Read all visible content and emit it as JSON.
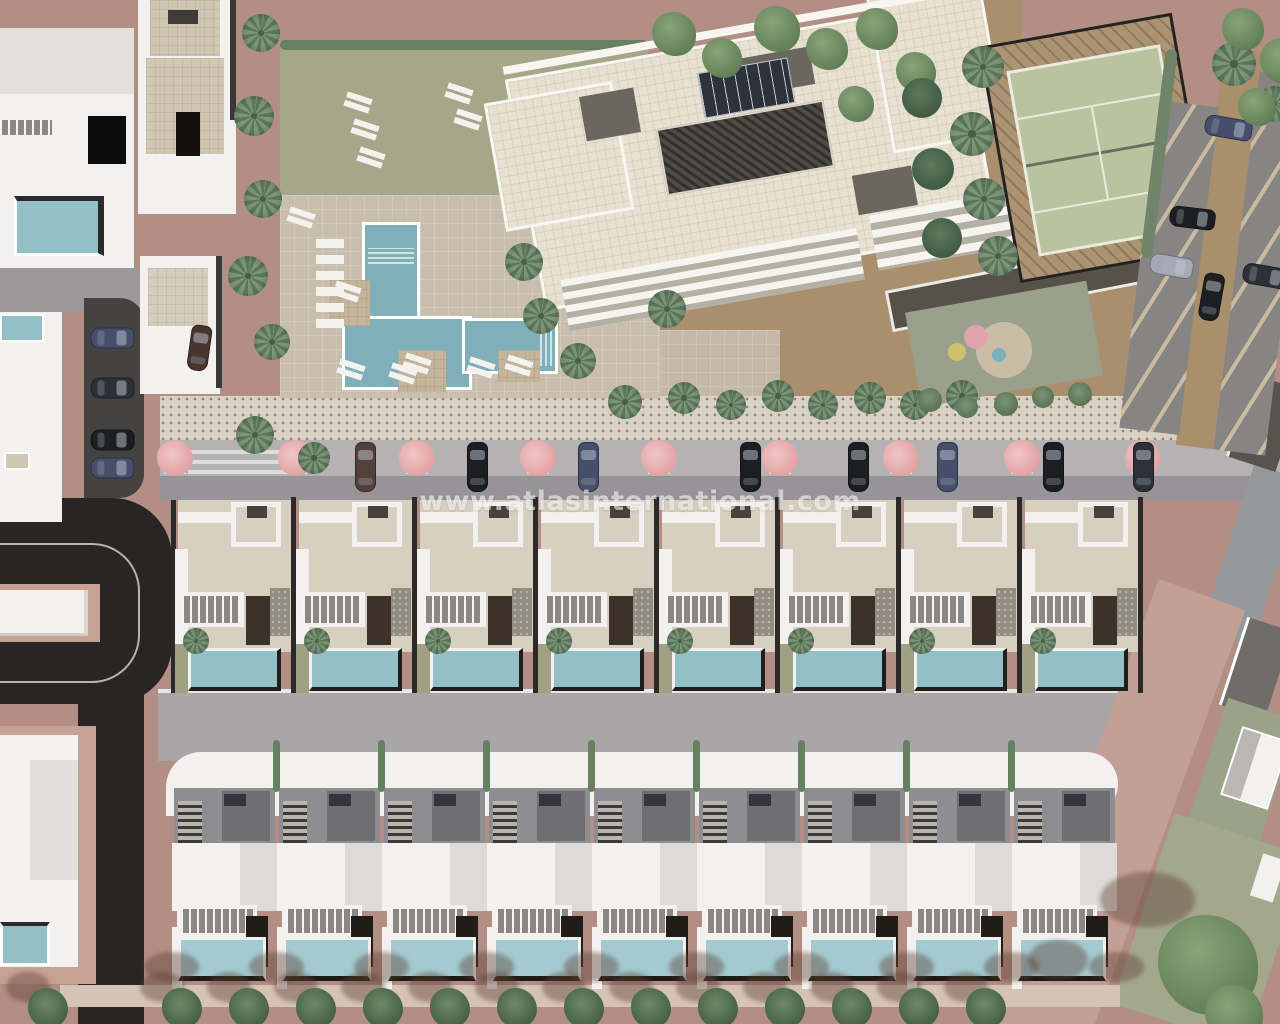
{
  "watermark": {
    "text": "www.atlasinternational.com"
  },
  "palette": {
    "ground": "#b28e85",
    "ground_light": "#c6a294",
    "road_dark": "#282625",
    "road_mid": "#a8a6a7",
    "road_pink": "#c2a095",
    "street_lane": "#969496",
    "street_bays": "#b4b2b3",
    "sidewalk": "#d9d2c4",
    "sidewalk_dot": "#8f8878",
    "lawn": "#a5a789",
    "hedge": "#66815f",
    "deck": "#c8bead",
    "pool": "#7fafb8",
    "villa_pool": "#93bfc6",
    "bottom_pool": "#a3cad0",
    "white": "#f2f1ef",
    "white_shade": "#dcdbd8",
    "beige_roof": "#d7cfbf",
    "beige_wall": "#d0c7b3",
    "stone": "#938c80",
    "olive": "#9fa084",
    "door_brown": "#3d322a",
    "door_dark": "#201c18",
    "roof_gray": "#8e8e92",
    "roof_gray_dark": "#6f6f73",
    "apt_cream": "#e8e1d1",
    "apt_cut": "#6b675f",
    "trellis": "#4e4a44",
    "solar": "#2e333b",
    "tennis_green": "#b9c3a0",
    "tennis_tan": "#ac9372",
    "dirt": "#a98f6e",
    "bay_gray": "#868482",
    "pink_tree": "#e2a2a4",
    "palm": "#7d9478",
    "palm_dark": "#5a775c",
    "watermark": "rgba(255,255,255,0.6)",
    "car_navy": "#454e6b",
    "car_black": "#1d1e21",
    "car_brown": "#54403a",
    "car_silver": "#a7abb8",
    "car_dark": "#2e3038",
    "car_maroon": "#4a342e"
  },
  "scene": {
    "middle_villas": {
      "count": 8,
      "x0": 175,
      "y0": 497,
      "w": 121,
      "h": 196
    },
    "bottom_villas": {
      "count": 9,
      "x0": 172,
      "y0": 785,
      "w": 105,
      "h": 205
    },
    "street_trees": {
      "xs": [
        175,
        296,
        417,
        538,
        659,
        780,
        901,
        1022,
        1143
      ],
      "y": 444
    },
    "cars": [
      {
        "x": 355,
        "y": 442,
        "r": 0,
        "len": 50,
        "c": "brown"
      },
      {
        "x": 467,
        "y": 442,
        "r": 0,
        "len": 50,
        "c": "black"
      },
      {
        "x": 578,
        "y": 442,
        "r": 0,
        "len": 50,
        "c": "navy"
      },
      {
        "x": 740,
        "y": 442,
        "r": 0,
        "len": 50,
        "c": "black"
      },
      {
        "x": 848,
        "y": 442,
        "r": 0,
        "len": 50,
        "c": "black"
      },
      {
        "x": 937,
        "y": 442,
        "r": 0,
        "len": 50,
        "c": "navy"
      },
      {
        "x": 1043,
        "y": 442,
        "r": 0,
        "len": 50,
        "c": "black"
      },
      {
        "x": 1133,
        "y": 442,
        "r": 0,
        "len": 50,
        "c": "dark"
      },
      {
        "x": 102,
        "y": 316,
        "r": 90,
        "len": 44,
        "c": "navy"
      },
      {
        "x": 102,
        "y": 366,
        "r": 90,
        "len": 44,
        "c": "dark"
      },
      {
        "x": 102,
        "y": 418,
        "r": 90,
        "len": 44,
        "c": "black"
      },
      {
        "x": 102,
        "y": 446,
        "r": 90,
        "len": 44,
        "c": "navy"
      },
      {
        "x": 189,
        "y": 325,
        "r": 8,
        "len": 46,
        "c": "maroon"
      },
      {
        "x": 1218,
        "y": 104,
        "r": 100,
        "len": 48,
        "c": "navy"
      },
      {
        "x": 1182,
        "y": 195,
        "r": 97,
        "len": 46,
        "c": "black"
      },
      {
        "x": 1161,
        "y": 244,
        "r": 100,
        "len": 44,
        "c": "silver"
      },
      {
        "x": 1201,
        "y": 273,
        "r": 10,
        "len": 48,
        "c": "black"
      },
      {
        "x": 1255,
        "y": 253,
        "r": 100,
        "len": 46,
        "c": "dark"
      }
    ],
    "palms": [
      [
        242,
        14,
        38
      ],
      [
        234,
        96,
        40
      ],
      [
        244,
        180,
        38
      ],
      [
        228,
        256,
        40
      ],
      [
        254,
        324,
        36
      ],
      [
        236,
        416,
        38
      ],
      [
        298,
        442,
        32
      ],
      [
        505,
        243,
        38
      ],
      [
        523,
        298,
        36
      ],
      [
        560,
        343,
        36
      ],
      [
        608,
        385,
        34
      ],
      [
        648,
        290,
        38
      ],
      [
        668,
        382,
        32
      ],
      [
        716,
        390,
        30
      ],
      [
        762,
        380,
        32
      ],
      [
        808,
        390,
        30
      ],
      [
        854,
        382,
        32
      ],
      [
        900,
        390,
        30
      ],
      [
        946,
        380,
        32
      ],
      [
        962,
        46,
        42
      ],
      [
        950,
        112,
        44
      ],
      [
        963,
        178,
        42
      ],
      [
        978,
        236,
        40
      ],
      [
        1212,
        42,
        44
      ],
      [
        1256,
        86,
        36
      ]
    ],
    "leafy_trees": [
      [
        652,
        12,
        44
      ],
      [
        702,
        38,
        40
      ],
      [
        754,
        6,
        46
      ],
      [
        806,
        28,
        42
      ],
      [
        856,
        8,
        42
      ],
      [
        896,
        52,
        40
      ],
      [
        838,
        86,
        36
      ],
      [
        1222,
        8,
        42
      ],
      [
        1260,
        38,
        46
      ],
      [
        1238,
        88,
        38
      ],
      [
        1158,
        915,
        100
      ],
      [
        1205,
        985,
        58
      ]
    ],
    "cypress_trees": [
      [
        902,
        78,
        40
      ],
      [
        912,
        148,
        42
      ],
      [
        922,
        218,
        40
      ]
    ],
    "bushes": [
      [
        918,
        388,
        24
      ],
      [
        956,
        396,
        22
      ],
      [
        994,
        392,
        24
      ],
      [
        1032,
        386,
        22
      ],
      [
        1068,
        382,
        24
      ]
    ],
    "bottom_trees": {
      "xs": [
        28,
        162,
        229,
        296,
        363,
        430,
        497,
        564,
        631,
        698,
        765,
        832,
        899,
        966
      ],
      "y": 988,
      "size": 40
    },
    "loungers": [
      [
        345,
        95
      ],
      [
        352,
        122
      ],
      [
        358,
        150
      ],
      [
        288,
        210
      ],
      [
        446,
        86
      ],
      [
        455,
        112
      ],
      [
        334,
        284
      ],
      [
        404,
        356
      ],
      [
        506,
        358
      ],
      [
        338,
        362
      ],
      [
        390,
        366
      ],
      [
        468,
        360
      ]
    ],
    "shadow_ellipses": [
      [
        1100,
        872,
        95,
        55
      ],
      [
        1028,
        940,
        60,
        40
      ]
    ],
    "playground_circles": [
      {
        "x": 976,
        "y": 337,
        "r": 12,
        "c": "#dfa3ab"
      },
      {
        "x": 957,
        "y": 352,
        "r": 9,
        "c": "#cfc06e"
      },
      {
        "x": 999,
        "y": 355,
        "r": 7,
        "c": "#79b2bf"
      }
    ]
  }
}
